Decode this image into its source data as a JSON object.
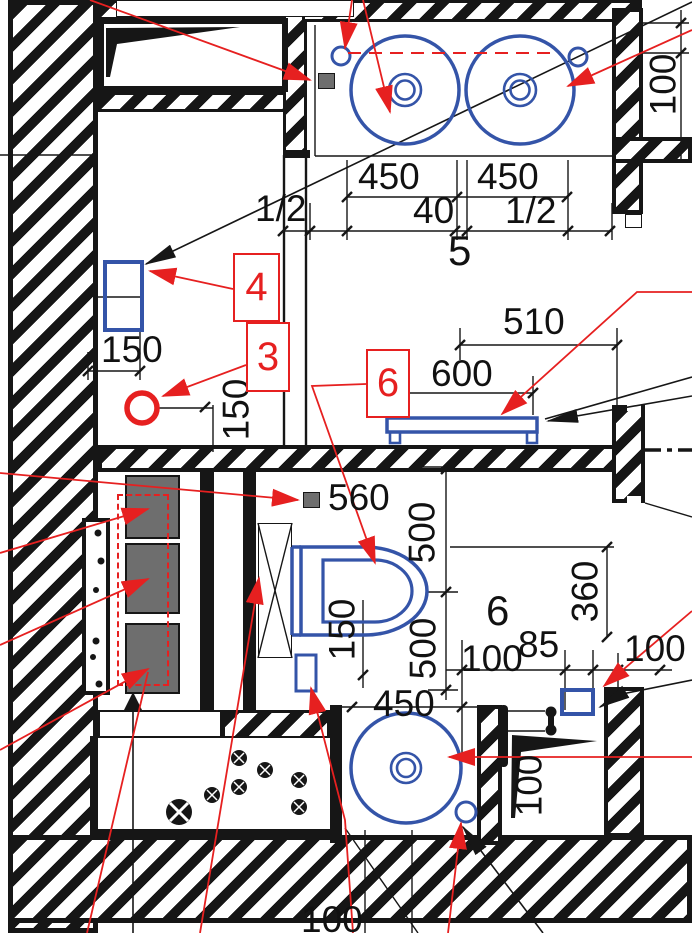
{
  "colors": {
    "accent_blue": "#3454a8",
    "accent_red": "#e62020",
    "line_dark": "#161616",
    "appliance_gray": "#6e6e6e"
  },
  "rooms": {
    "bathroom_number": "5",
    "wc_number": "6"
  },
  "callouts": {
    "item3": "3",
    "item4": "4",
    "item6": "6"
  },
  "dims": {
    "sink_left_width": "450",
    "sink_right_width": "450",
    "sink_gap": "40",
    "half_left": "1/2",
    "half_right": "1/2",
    "wall_right_100": "100",
    "rect_width_150": "150",
    "circle_offset_150": "150",
    "rail_510": "510",
    "rail_600": "600",
    "socket_560": "560",
    "wc_500_upper": "500",
    "wc_500_lower": "500",
    "toilet_150": "150",
    "wc_360": "360",
    "wc_100_left": "100",
    "wc_85": "85",
    "wc_100_right": "100",
    "basin_450": "450",
    "niche_100": "100",
    "bottom_100": "100"
  }
}
